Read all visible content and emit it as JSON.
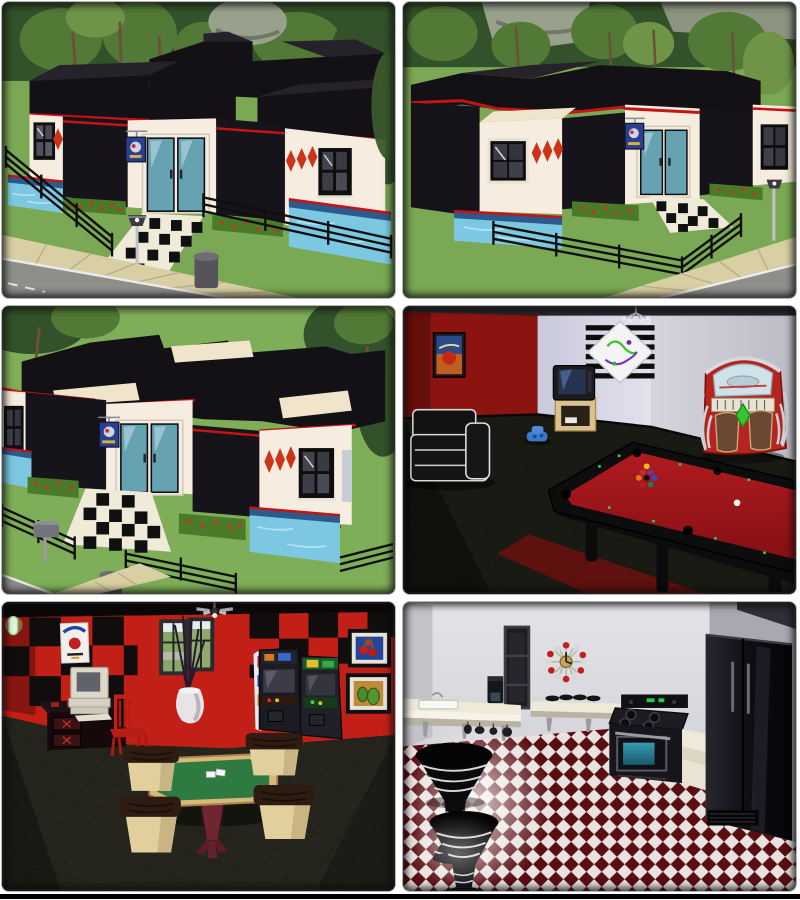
{
  "window": {
    "width": 800,
    "height": 900,
    "background": "#ffffff",
    "bottom_bar_color": "#000000"
  },
  "collage": {
    "rows": 3,
    "cols": 2,
    "panels": [
      {
        "id": "exterior-front",
        "label": "House exterior, front view: black cross roof, cream walls, red trim, teal double doors, two pools, checkered walkway, black fence, street lamp and trash can"
      },
      {
        "id": "exterior-corner",
        "label": "House exterior, corner view: black roof, cream wing with red diamonds, teal doors, pool, black fence, tree line and rock cliff, sidewalk and road"
      },
      {
        "id": "exterior-front-close",
        "label": "House exterior, close front view: cross-shaped black roof, teal double doors, checkered walkway, pool, flower beds, mailbox and fence"
      },
      {
        "id": "billiards-room",
        "label": "Interior billiards room: red and lavender walls, red-felt pool table with racked balls, jukebox, TV on stand, black sofa, graffiti poster"
      },
      {
        "id": "poker-room",
        "label": "Interior game room: red walls with black checker band, octagonal green poker table with four stools, arcade cabinets, computer desk, red chair, corner window"
      },
      {
        "id": "kitchen",
        "label": "Interior kitchen: white walls, red-and-white checkered floor, black fridge and stove, white counters with sink, ball clock, striped pedestal stools"
      }
    ]
  },
  "palette": {
    "grass": "#7aa854",
    "treeDark": "#33512a",
    "treeMid": "#527a36",
    "rockGray": "#98a18c",
    "roofBlack": "#141116",
    "wallCream": "#f6ecdf",
    "wallBlack": "#16131a",
    "trimRed": "#c41414",
    "doorTeal": "#66a2b2",
    "poolWater": "#7cc8e2",
    "poolTileBand": "#2c5a8c",
    "flowerGreen": "#4a7a2a",
    "flowerRed": "#cc3318",
    "fenceBlack": "#0f0f0f",
    "pathTan": "#d9cfa4",
    "roadGray": "#8e8e8a",
    "walkWhite": "#f0ead8",
    "redWallPool": "#8c1410",
    "grayWall": "#cdccd4",
    "floorDark": "#1a1a14",
    "feltRed": "#a8181c",
    "rugRed": "#64100f",
    "jukeRed": "#b5241e",
    "pokerWallRed": "#c22017",
    "pokerFelt": "#2f7a40",
    "pokerWood": "#d8b87a",
    "stoolCream": "#e2cf9e",
    "slabBrown": "#2e1c12",
    "kitchenWall": "#d8d8dc",
    "counterWhite": "#efe9da",
    "applianceBlack": "#15151b",
    "ovenTeal": "#2a8aa0",
    "clockRed": "#c22020",
    "clockSilver": "#d8d8d8",
    "kFloorRed": "#5a0d12",
    "kFloorWhite": "#e8e2e0",
    "footerBlack": "#000000"
  }
}
